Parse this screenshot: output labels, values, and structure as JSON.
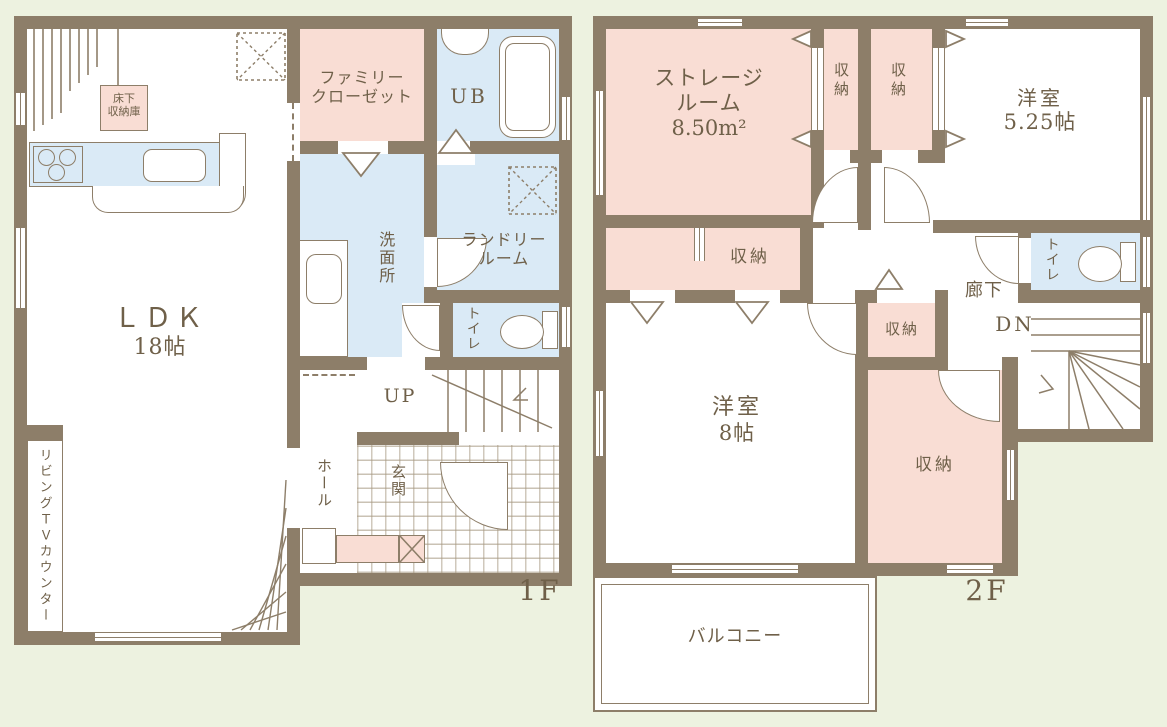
{
  "colors": {
    "background": "#edf2e0",
    "wall": "#8d7e69",
    "room_pink": "#f9ddd4",
    "room_blue": "#daeaf6",
    "text": "#6f6049"
  },
  "floor1": {
    "caption": "1F",
    "ldk_name": "ＬＤＫ",
    "ldk_size": "18帖",
    "underfloor_line1": "床下",
    "underfloor_line2": "収納庫",
    "family_closet_line1": "ファミリー",
    "family_closet_line2": "クローゼット",
    "unit_bath": "UB",
    "washroom": "洗面所",
    "laundry_line1": "ランドリー",
    "laundry_line2": "ルーム",
    "toilet": "トイレ",
    "stairs_up": "UP",
    "hall": "ホール",
    "entrance": "玄関",
    "tv_counter": "リビングＴＶカウンター"
  },
  "floor2": {
    "caption": "2F",
    "storage_line1": "ストレージ",
    "storage_line2": "ルーム",
    "storage_size": "8.50m²",
    "closet_a": "収納",
    "closet_b": "収納",
    "room525_line1": "洋室",
    "room525_line2": "5.25帖",
    "toilet": "トイレ",
    "corridor": "廊下",
    "stairs_dn": "DN",
    "closet_hall": "収納",
    "closet_small": "収納",
    "room8_line1": "洋室",
    "room8_line2": "8帖",
    "closet_walkin": "収納",
    "balcony": "バルコニー"
  }
}
